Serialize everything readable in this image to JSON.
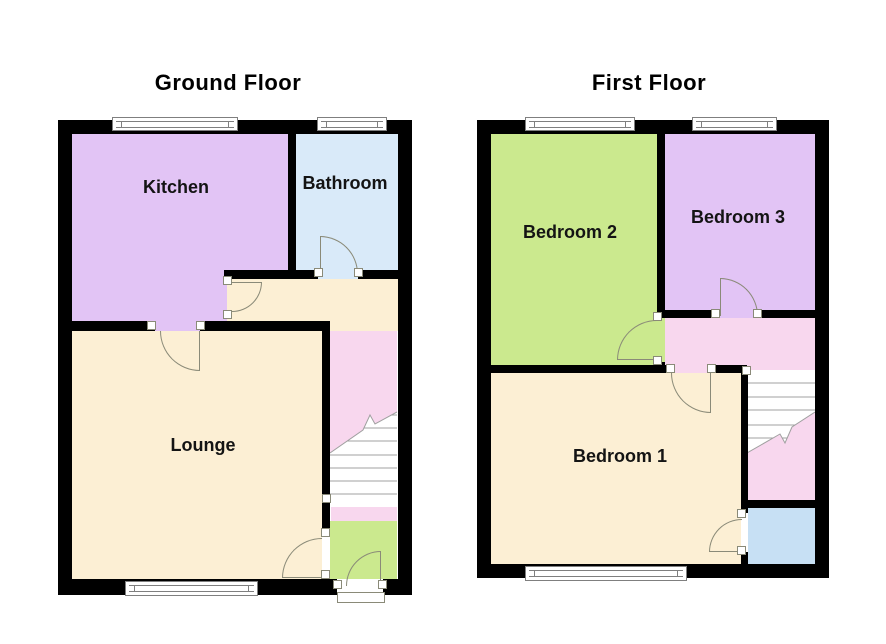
{
  "floors": [
    {
      "title": "Ground Floor",
      "rooms": [
        "Kitchen",
        "Bathroom",
        "Lounge"
      ]
    },
    {
      "title": "First Floor",
      "rooms": [
        "Bedroom 2",
        "Bedroom 3",
        "Bedroom 1"
      ]
    }
  ],
  "colors": {
    "wall": "#000000",
    "kitchen_purple": "#e2c4f5",
    "bathroom_blue": "#d9eaf9",
    "floor_cream": "#fcefd4",
    "stairs_pink": "#f8d7ee",
    "room_green": "#cbe98e",
    "store_blue": "#c7e0f4",
    "door_arc": "#8a8a78",
    "window_frame": "#7f7f7f"
  }
}
